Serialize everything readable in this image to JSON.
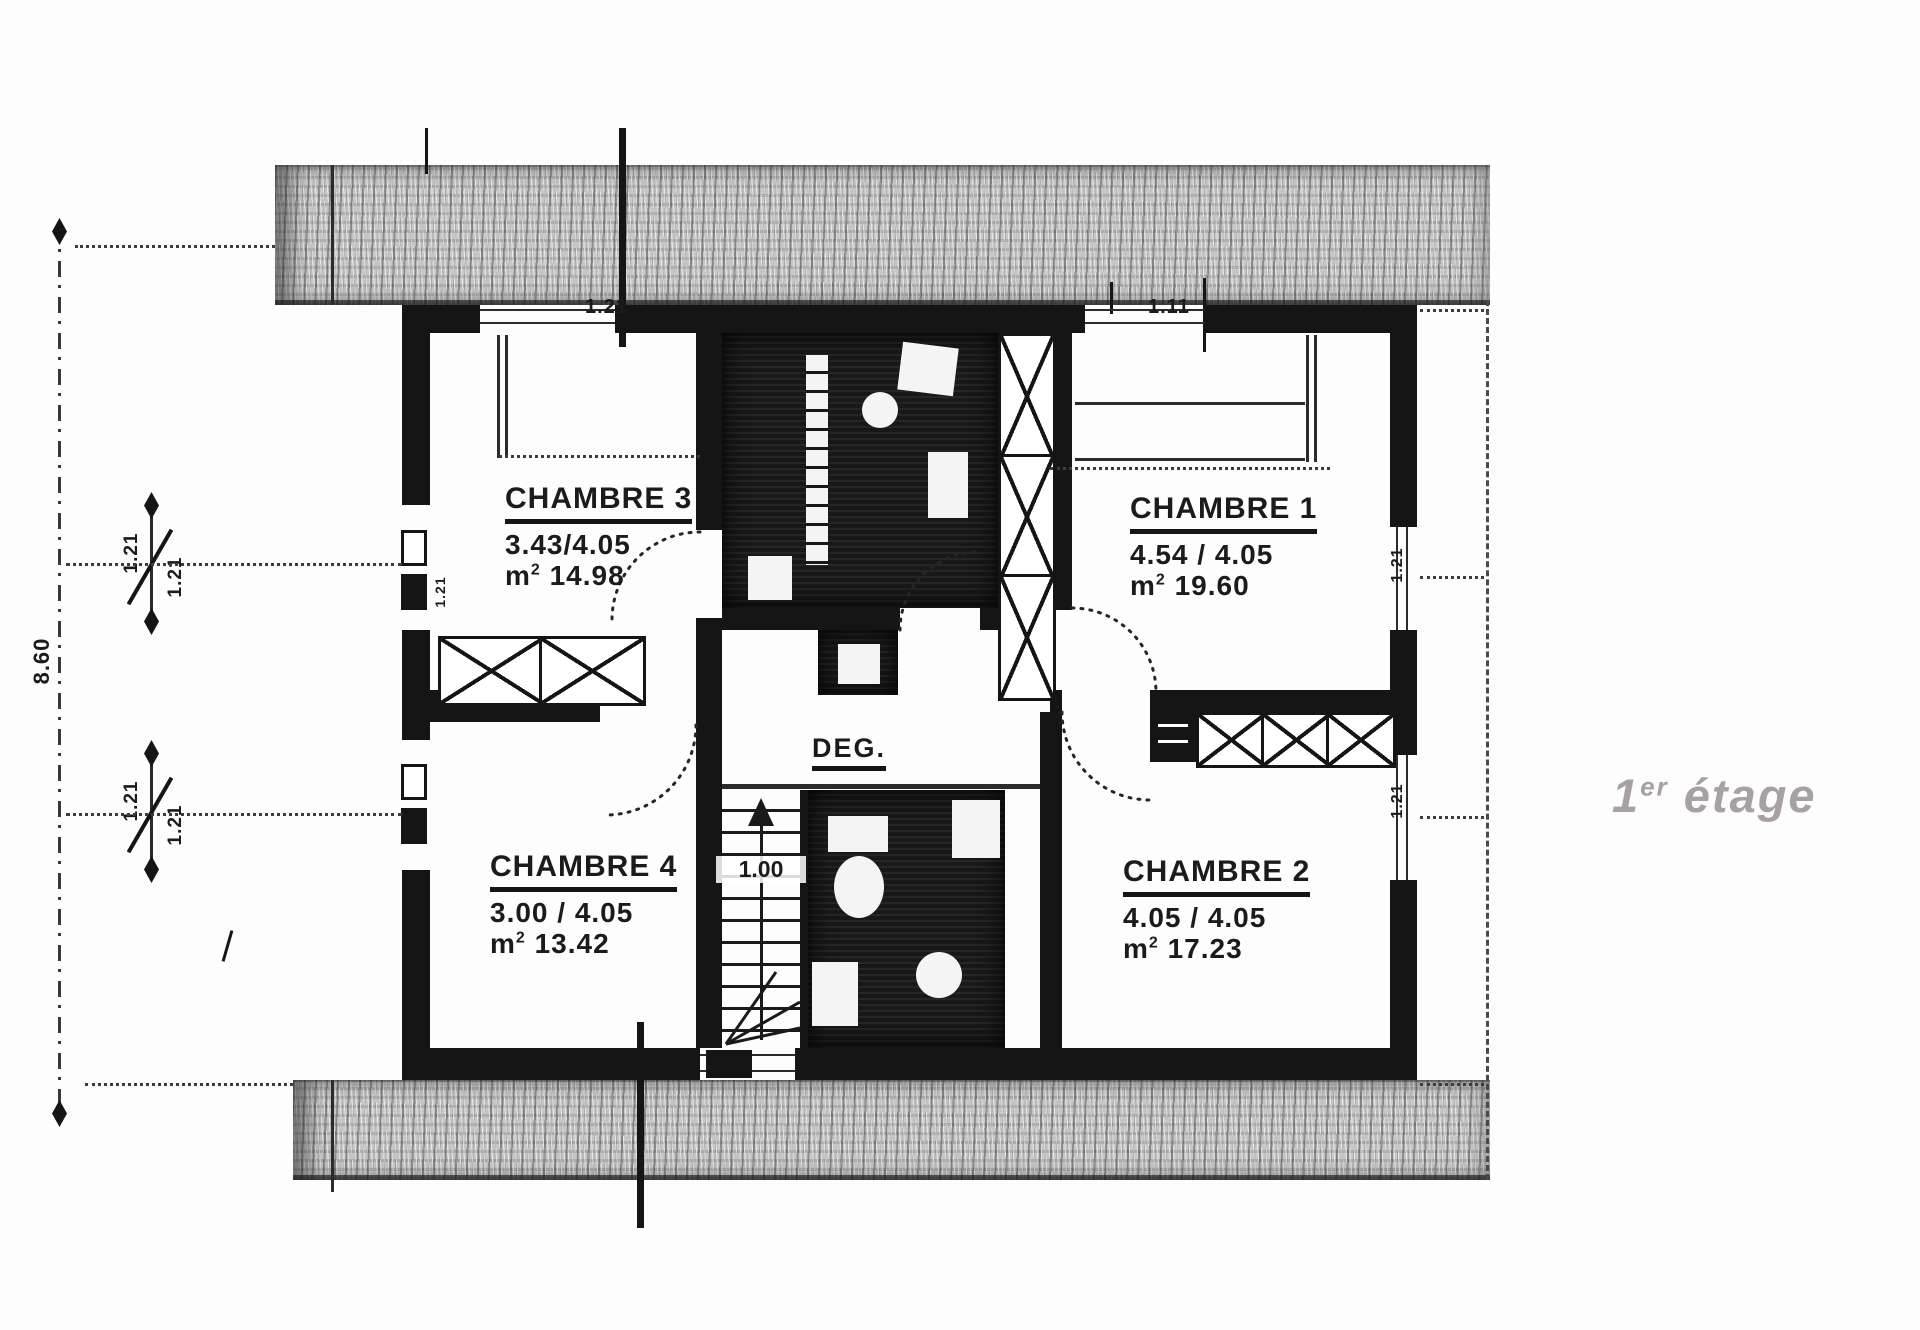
{
  "floor_title": {
    "number": "1",
    "ordinal": "er",
    "word": "étage"
  },
  "rooms": [
    {
      "id": "chambre-3",
      "name": "CHAMBRE 3",
      "dimensions": "3.43/4.05",
      "area_unit": "m",
      "area_exp": "2",
      "area": "14.98"
    },
    {
      "id": "chambre-1",
      "name": "CHAMBRE 1",
      "dimensions": "4.54 / 4.05",
      "area_unit": "m",
      "area_exp": "2",
      "area": "19.60"
    },
    {
      "id": "chambre-4",
      "name": "CHAMBRE 4",
      "dimensions": "3.00 / 4.05",
      "area_unit": "m",
      "area_exp": "2",
      "area": "13.42"
    },
    {
      "id": "chambre-2",
      "name": "CHAMBRE 2",
      "dimensions": "4.05 / 4.05",
      "area_unit": "m",
      "area_exp": "2",
      "area": "17.23"
    }
  ],
  "hall": {
    "label": "DEG."
  },
  "stairs": {
    "width_label": "1.00"
  },
  "windows": {
    "top_left": "1.21",
    "top_right": "1.11",
    "left_upper_top": "1.21",
    "left_upper_bottom": "1.21",
    "left_lower_top": "1.21",
    "left_lower_bottom": "1.21",
    "left_jamb_label": "1.21",
    "right_upper": "1.21",
    "right_lower": "1.21"
  },
  "dimensions": {
    "overall_height": "8.60"
  },
  "colors": {
    "ink": "#151515",
    "hatch_base": "#c7c7c7",
    "title_gray": "#a8a1a1",
    "paper": "#fdfdfd"
  }
}
